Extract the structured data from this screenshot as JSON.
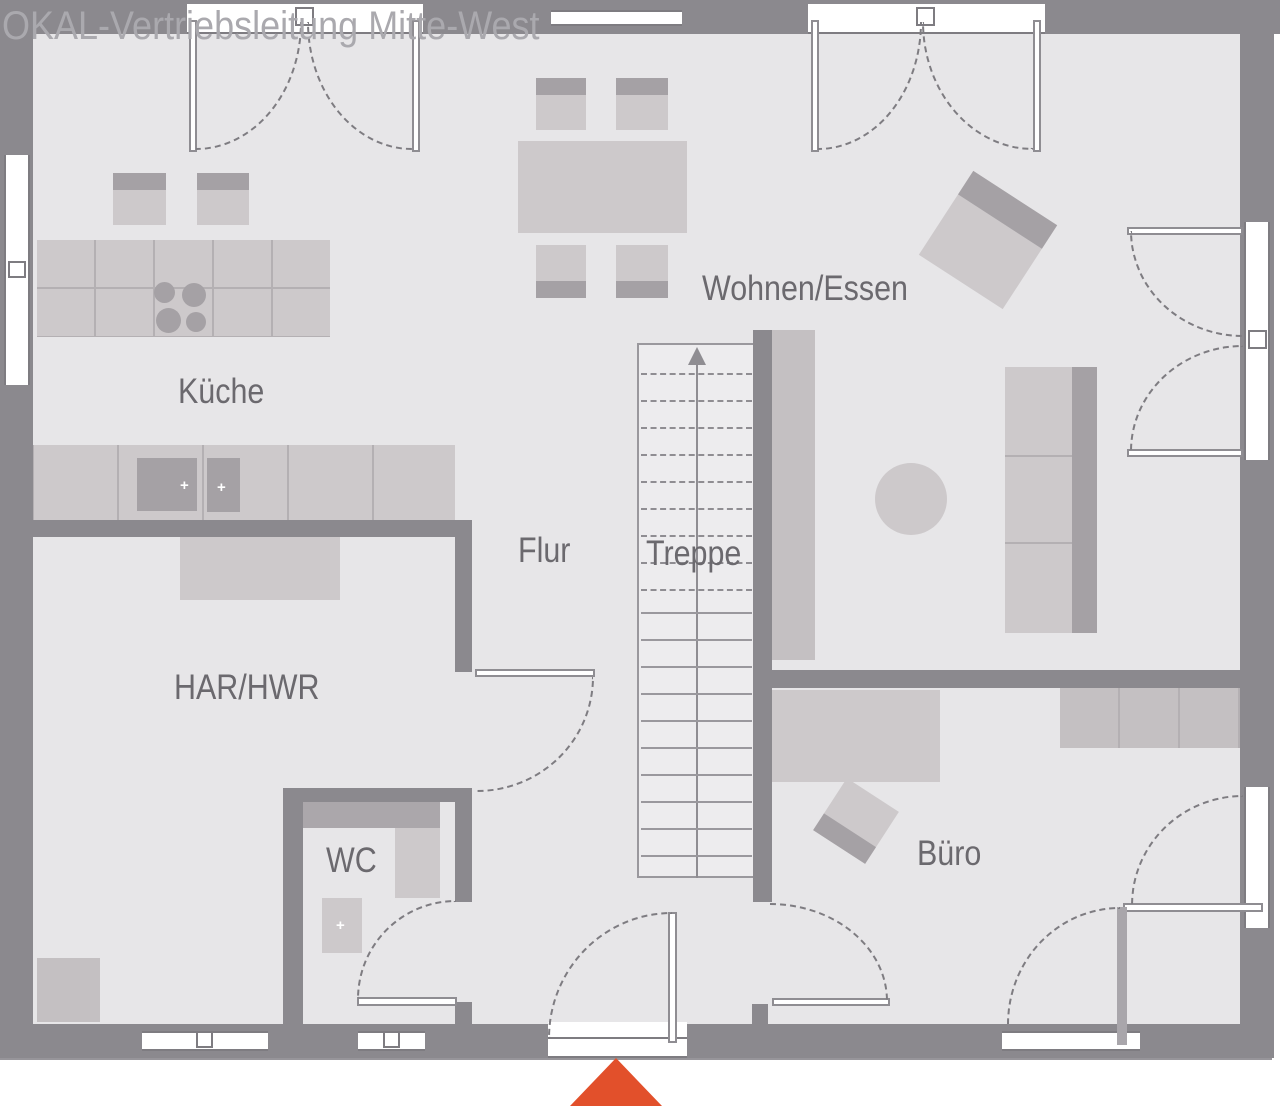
{
  "watermark": "OKAL-Vertriebsleitung Mitte-West",
  "rooms": {
    "kueche": {
      "label": "Küche"
    },
    "wohnen_essen": {
      "label": "Wohnen/Essen"
    },
    "flur": {
      "label": "Flur"
    },
    "treppe": {
      "label": "Treppe"
    },
    "har_hwr": {
      "label": "HAR/HWR"
    },
    "wc": {
      "label": "WC"
    },
    "buero": {
      "label": "Büro"
    }
  },
  "stairs": {
    "dashed_treads": 9,
    "solid_treads": 10,
    "arrow_direction": "up"
  },
  "icons": {
    "plus": "+"
  },
  "colors": {
    "wall": "#8b898e",
    "floor": "#e7e6e8",
    "stair_floor": "#edecee",
    "furniture_light": "#cdc9cb",
    "furniture_mid": "#c4c0c2",
    "furniture_dark": "#a5a1a5",
    "label_text": "#6b696e",
    "watermark_text": "#aaa9ae",
    "entry_marker": "#e2502b"
  }
}
